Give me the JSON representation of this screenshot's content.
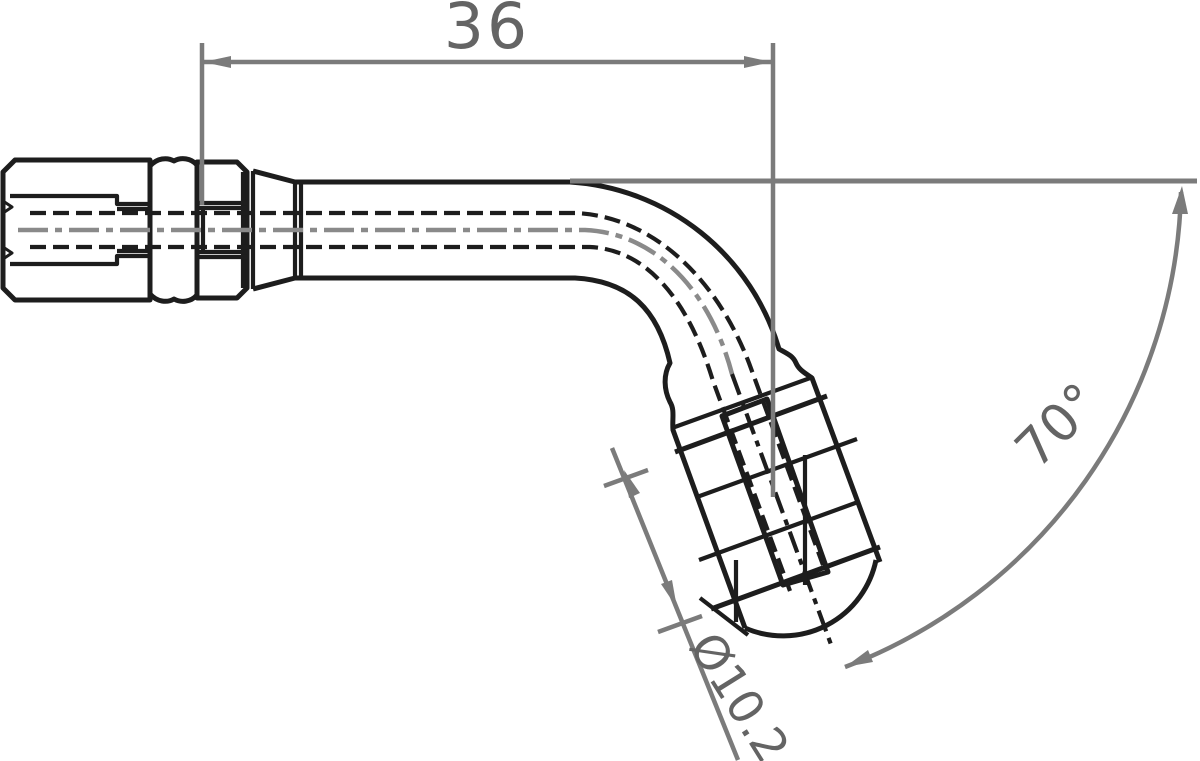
{
  "drawing": {
    "labels": {
      "length": "36",
      "angle": "70°",
      "diameter": "Ø10.2"
    },
    "colors": {
      "outline": "#1d1d1d",
      "dimension": "#7b7b7b",
      "centerline": "#8a8a8a",
      "dim-text": "#646464",
      "background": "#ffffff"
    }
  }
}
